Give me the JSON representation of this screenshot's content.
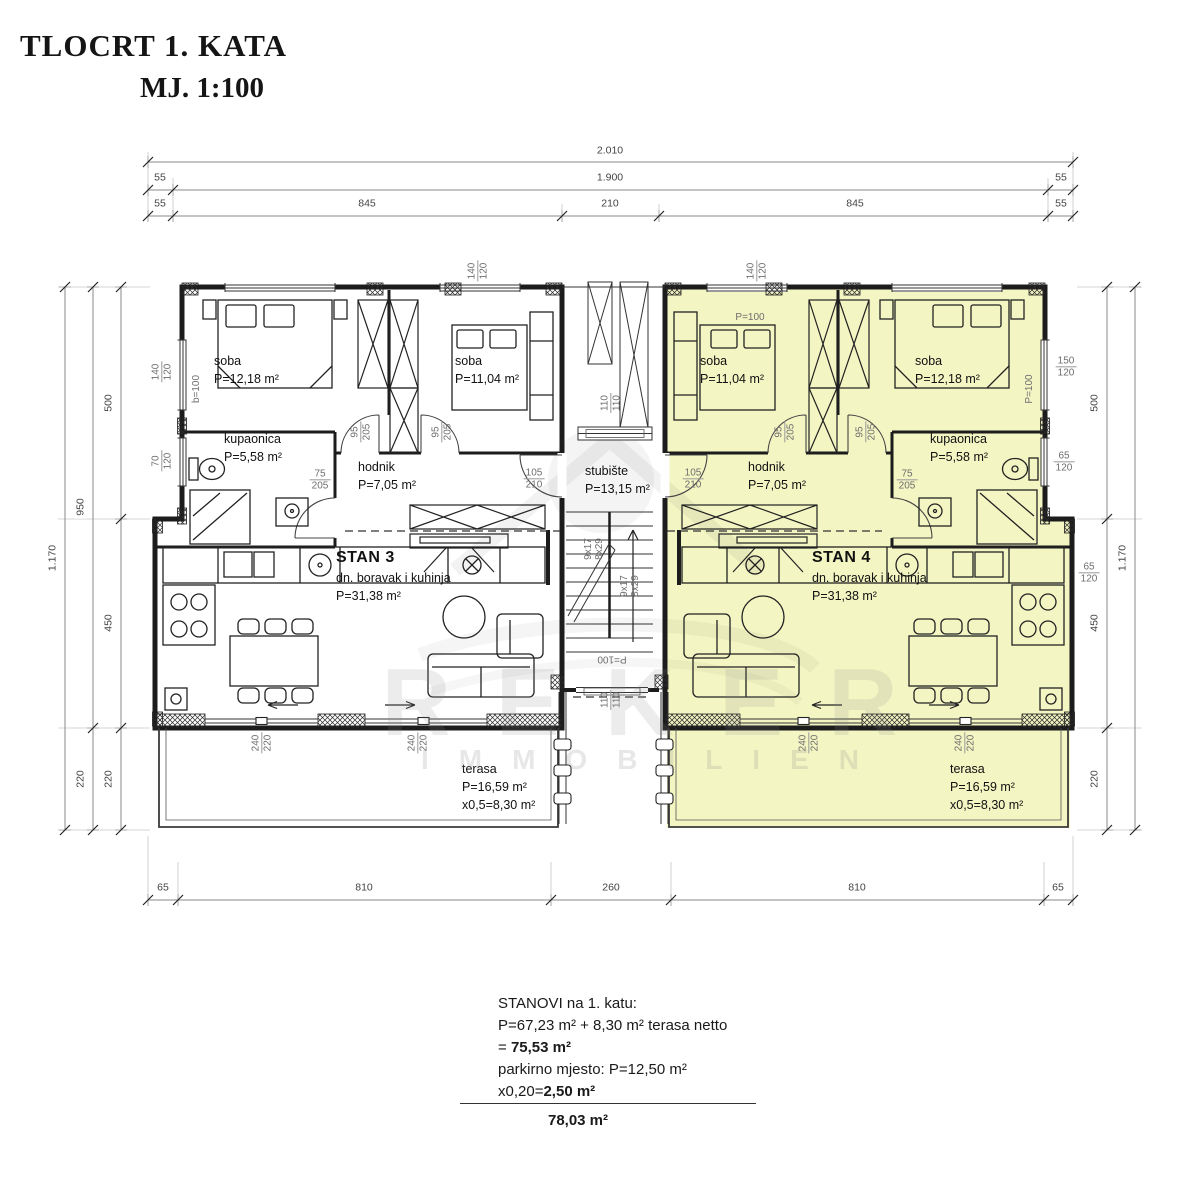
{
  "title": {
    "line1": "TLOCRT 1. KATA",
    "line2": "MJ. 1:100"
  },
  "watermark": {
    "line1": "REKER",
    "line2": "IMMOBILIEN"
  },
  "colors": {
    "apartment_highlight": "#f3f5c3",
    "wall": "#1c1c1c",
    "dim_text": "#444444",
    "opening_label": "#6e6e6e"
  },
  "dimensions": {
    "top": {
      "total": "2.010",
      "row2": [
        "55",
        "1.900",
        "55"
      ],
      "row3": [
        "55",
        "845",
        "210",
        "845",
        "55"
      ]
    },
    "bottom": [
      "65",
      "810",
      "260",
      "810",
      "65"
    ],
    "left": {
      "total": "1.170",
      "outer": [
        "950",
        "220"
      ],
      "inner": [
        "500",
        "450",
        "220"
      ]
    },
    "right": {
      "total": "1.170",
      "inner": [
        "500",
        "450",
        "220"
      ]
    }
  },
  "stan3": {
    "name": "STAN 3",
    "type": "dn. boravak i kuhinja",
    "area": "P=31,38 m²",
    "soba1": {
      "name": "soba",
      "area": "P=12,18 m²"
    },
    "soba2": {
      "name": "soba",
      "area": "P=11,04 m²"
    },
    "kupaonica": {
      "name": "kupaonica",
      "area": "P=5,58 m²"
    },
    "hodnik": {
      "name": "hodnik",
      "area": "P=7,05 m²"
    },
    "terasa": {
      "name": "terasa",
      "area": "P=16,59 m²",
      "calc": "x0,5=8,30 m²"
    }
  },
  "stan4": {
    "name": "STAN 4",
    "type": "dn. boravak i kuhinja",
    "area": "P=31,38 m²",
    "soba1": {
      "name": "soba",
      "area": "P=11,04 m²"
    },
    "soba2": {
      "name": "soba",
      "area": "P=12,18 m²"
    },
    "kupaonica": {
      "name": "kupaonica",
      "area": "P=5,58 m²"
    },
    "hodnik": {
      "name": "hodnik",
      "area": "P=7,05 m²"
    },
    "terasa": {
      "name": "terasa",
      "area": "P=16,59 m²",
      "calc": "x0,5=8,30 m²"
    }
  },
  "stubiste": {
    "name": "stubište",
    "area": "P=13,15 m²",
    "flight": "9x17",
    "riser": "8x29"
  },
  "openings": {
    "n95": "95",
    "n205": "205",
    "n75": "75",
    "n105": "105",
    "n210": "210",
    "n140": "140",
    "n120": "120",
    "n110": "110",
    "n70": "70",
    "n150": "150",
    "n65": "65",
    "n240": "240",
    "n220": "220",
    "p100": "P=100",
    "b100": "b=100"
  },
  "summary": {
    "line1": "STANOVI na 1. katu:",
    "line2": "P=67,23 m² + 8,30 m² terasa netto",
    "line3_pre": "= ",
    "line3_bold": "75,53 m²",
    "line4": "parkirno mjesto: P=12,50 m²",
    "line5_pre": "x0,20=",
    "line5_bold": "2,50 m²",
    "total": "78,03 m²"
  }
}
